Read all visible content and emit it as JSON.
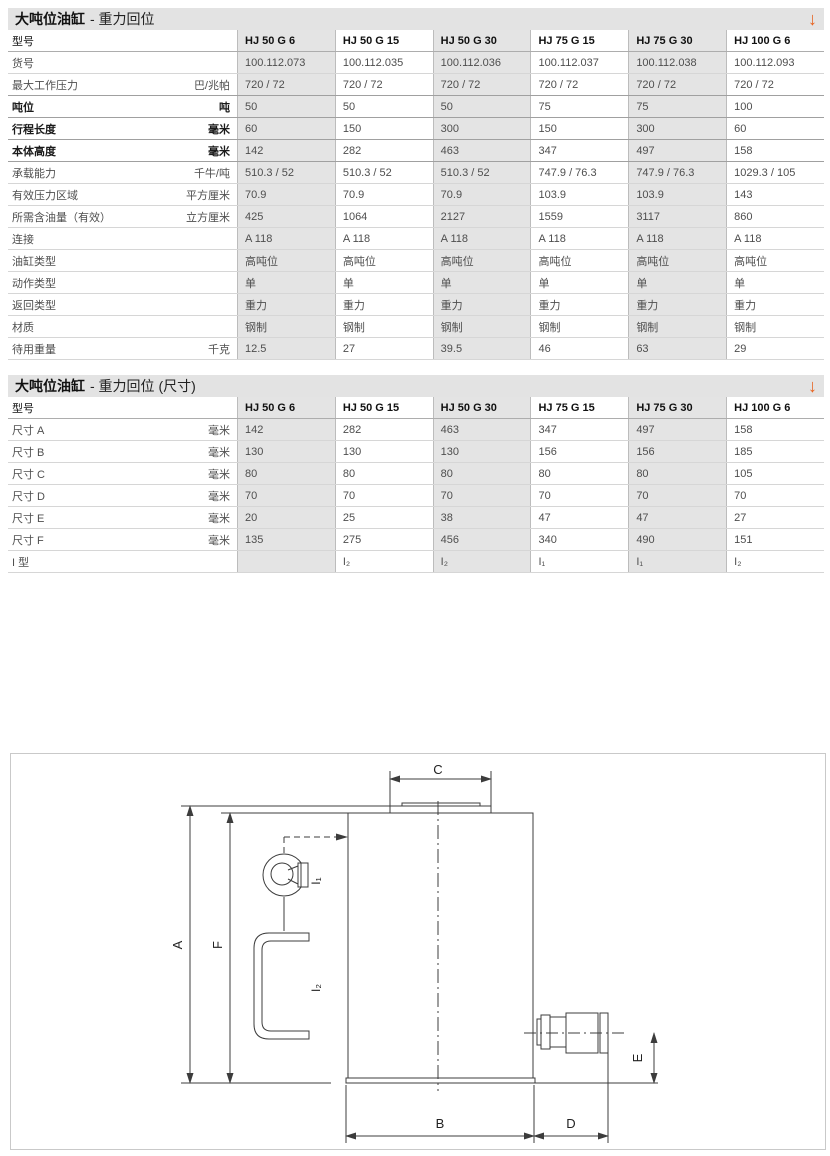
{
  "accent": {
    "arrow_color": "#e8611c",
    "shaded_column_bg": "#e4e4e4"
  },
  "section1": {
    "title_main": "大吨位油缸",
    "title_sub": "- 重力回位",
    "arrow_icon": "↓",
    "table": {
      "model_header": "型号",
      "columns": [
        "HJ 50 G 6",
        "HJ 50 G 15",
        "HJ 50 G 30",
        "HJ 75 G 15",
        "HJ 75 G 30",
        "HJ 100 G 6"
      ],
      "rows": [
        {
          "label": "货号",
          "unit": "",
          "bold": false,
          "values": [
            "100.112.073",
            "100.112.035",
            "100.112.036",
            "100.112.037",
            "100.112.038",
            "100.112.093"
          ]
        },
        {
          "label": "最大工作压力",
          "unit": "巴/兆帕",
          "bold": false,
          "values": [
            "720 / 72",
            "720 / 72",
            "720 / 72",
            "720 / 72",
            "720 / 72",
            "720 / 72"
          ]
        },
        {
          "label": "吨位",
          "unit": "吨",
          "bold": true,
          "values": [
            "50",
            "50",
            "50",
            "75",
            "75",
            "100"
          ]
        },
        {
          "label": "行程长度",
          "unit": "毫米",
          "bold": true,
          "values": [
            "60",
            "150",
            "300",
            "150",
            "300",
            "60"
          ]
        },
        {
          "label": "本体高度",
          "unit": "毫米",
          "bold": true,
          "values": [
            "142",
            "282",
            "463",
            "347",
            "497",
            "158"
          ]
        },
        {
          "label": "承载能力",
          "unit": "千牛/吨",
          "bold": false,
          "values": [
            "510.3 / 52",
            "510.3 / 52",
            "510.3 / 52",
            "747.9 / 76.3",
            "747.9 / 76.3",
            "1029.3 / 105"
          ]
        },
        {
          "label": "有效压力区域",
          "unit": "平方厘米",
          "bold": false,
          "values": [
            "70.9",
            "70.9",
            "70.9",
            "103.9",
            "103.9",
            "143"
          ]
        },
        {
          "label": "所需含油量（有效）",
          "unit": "立方厘米",
          "bold": false,
          "values": [
            "425",
            "1064",
            "2127",
            "1559",
            "3117",
            "860"
          ]
        },
        {
          "label": "连接",
          "unit": "",
          "bold": false,
          "values": [
            "A 118",
            "A 118",
            "A 118",
            "A 118",
            "A 118",
            "A 118"
          ]
        },
        {
          "label": "油缸类型",
          "unit": "",
          "bold": false,
          "values": [
            "高吨位",
            "高吨位",
            "高吨位",
            "高吨位",
            "高吨位",
            "高吨位"
          ]
        },
        {
          "label": "动作类型",
          "unit": "",
          "bold": false,
          "values": [
            "单",
            "单",
            "单",
            "单",
            "单",
            "单"
          ]
        },
        {
          "label": "返回类型",
          "unit": "",
          "bold": false,
          "values": [
            "重力",
            "重力",
            "重力",
            "重力",
            "重力",
            "重力"
          ]
        },
        {
          "label": "材质",
          "unit": "",
          "bold": false,
          "values": [
            "钢制",
            "钢制",
            "钢制",
            "钢制",
            "钢制",
            "钢制"
          ]
        },
        {
          "label": "待用重量",
          "unit": "千克",
          "bold": false,
          "values": [
            "12.5",
            "27",
            "39.5",
            "46",
            "63",
            "29"
          ]
        }
      ]
    }
  },
  "section2": {
    "title_main": "大吨位油缸",
    "title_sub": "- 重力回位 (尺寸)",
    "arrow_icon": "↓",
    "table": {
      "model_header": "型号",
      "columns": [
        "HJ 50 G 6",
        "HJ 50 G 15",
        "HJ 50 G 30",
        "HJ 75 G 15",
        "HJ 75 G 30",
        "HJ 100 G 6"
      ],
      "rows": [
        {
          "label": "尺寸 A",
          "unit": "毫米",
          "bold": false,
          "values": [
            "142",
            "282",
            "463",
            "347",
            "497",
            "158"
          ]
        },
        {
          "label": "尺寸 B",
          "unit": "毫米",
          "bold": false,
          "values": [
            "130",
            "130",
            "130",
            "156",
            "156",
            "185"
          ]
        },
        {
          "label": "尺寸 C",
          "unit": "毫米",
          "bold": false,
          "values": [
            "80",
            "80",
            "80",
            "80",
            "80",
            "105"
          ]
        },
        {
          "label": "尺寸 D",
          "unit": "毫米",
          "bold": false,
          "values": [
            "70",
            "70",
            "70",
            "70",
            "70",
            "70"
          ]
        },
        {
          "label": "尺寸 E",
          "unit": "毫米",
          "bold": false,
          "values": [
            "20",
            "25",
            "38",
            "47",
            "47",
            "27"
          ]
        },
        {
          "label": "尺寸 F",
          "unit": "毫米",
          "bold": false,
          "values": [
            "135",
            "275",
            "456",
            "340",
            "490",
            "151"
          ]
        },
        {
          "label": "I 型",
          "unit": "",
          "bold": false,
          "values": [
            "",
            "I₂",
            "I₂",
            "I₁",
            "I₁",
            "I₂"
          ]
        }
      ]
    }
  },
  "diagram": {
    "labels": {
      "a": "A",
      "b": "B",
      "c": "C",
      "d": "D",
      "e": "E",
      "f": "F",
      "i1": "I₁",
      "i2": "I₂"
    }
  }
}
